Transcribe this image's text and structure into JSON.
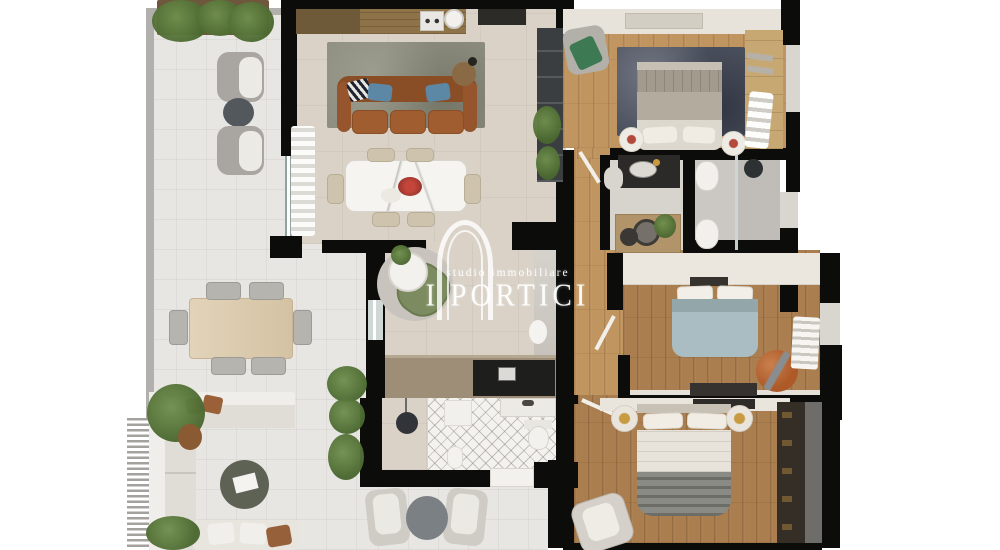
{
  "watermark": {
    "tagline": "studio immobiliare",
    "brand": "I PORTICI"
  },
  "colors": {
    "background": "#ffffff",
    "wall": "#0c0c0b",
    "terrace_floor": "#e7e6e3",
    "interior_floor": "#dad2c7",
    "wood_floor": "#c0955f",
    "wood_floor_dark": "#aa7e4f",
    "rug_living": "#8f8f80",
    "rug_master": "#4d5260",
    "sofa_leather": "#9a5a2d",
    "pillow_blue": "#5c88a6",
    "marble": "#f5f4f1",
    "plant": "#6f8f4d",
    "plant_dark": "#4a672f",
    "pouf_orange": "#ad5a28",
    "bed_blue": "#a9bdc2",
    "watermark": "#ffffff"
  }
}
